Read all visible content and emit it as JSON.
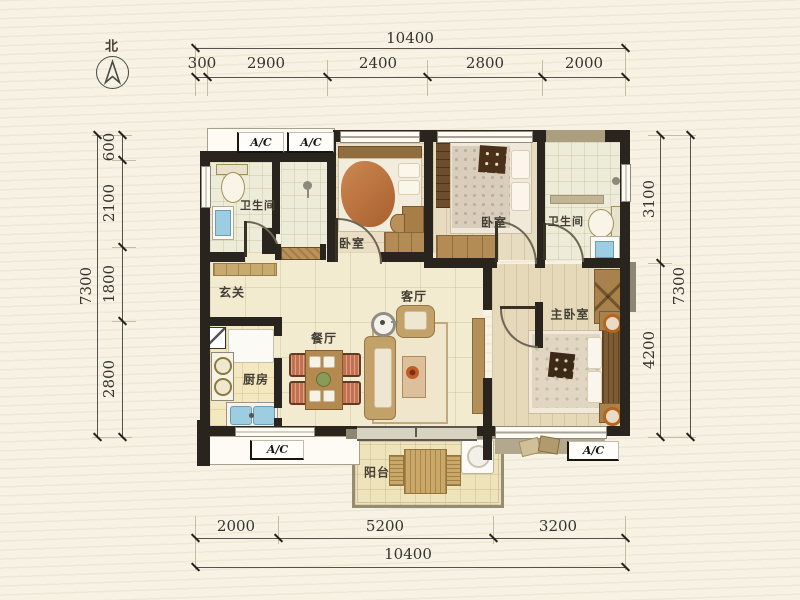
{
  "north": {
    "label": "北"
  },
  "dimensions": {
    "top": {
      "total": "10400",
      "segments": [
        "300",
        "2900",
        "2400",
        "2800",
        "2000"
      ]
    },
    "bottom": {
      "total": "10400",
      "segments": [
        "2000",
        "5200",
        "3200"
      ]
    },
    "left": {
      "total": "7300",
      "segments": [
        "600",
        "2100",
        "1800",
        "2800"
      ]
    },
    "right": {
      "total": "7300",
      "segments": [
        "3100",
        "4200"
      ]
    }
  },
  "rooms": {
    "bathroom_top_left": "卫生间",
    "bedroom_small": "卧室",
    "bedroom_top": "卧室",
    "bathroom_top_right": "卫生间",
    "foyer": "玄关",
    "living_room": "客厅",
    "dining_room": "餐厅",
    "kitchen": "厨房",
    "master_bedroom": "主卧室",
    "balcony": "阳台"
  },
  "ac_units": {
    "top_left": "A/C",
    "top_right": "A/C",
    "bottom_left": "A/C",
    "bottom_right": "A/C"
  },
  "colors": {
    "background": "#f7f2e4",
    "wall": "#29251e",
    "floor_tile": "#f2ebcf",
    "wood_floor": "#e7dcc0",
    "bath_tile": "#edecd9",
    "blanket_orange": "#bf7440",
    "chair_cushion": "#c4714f",
    "sink_blue": "#9ccde0",
    "dim_text": "#35332f"
  }
}
